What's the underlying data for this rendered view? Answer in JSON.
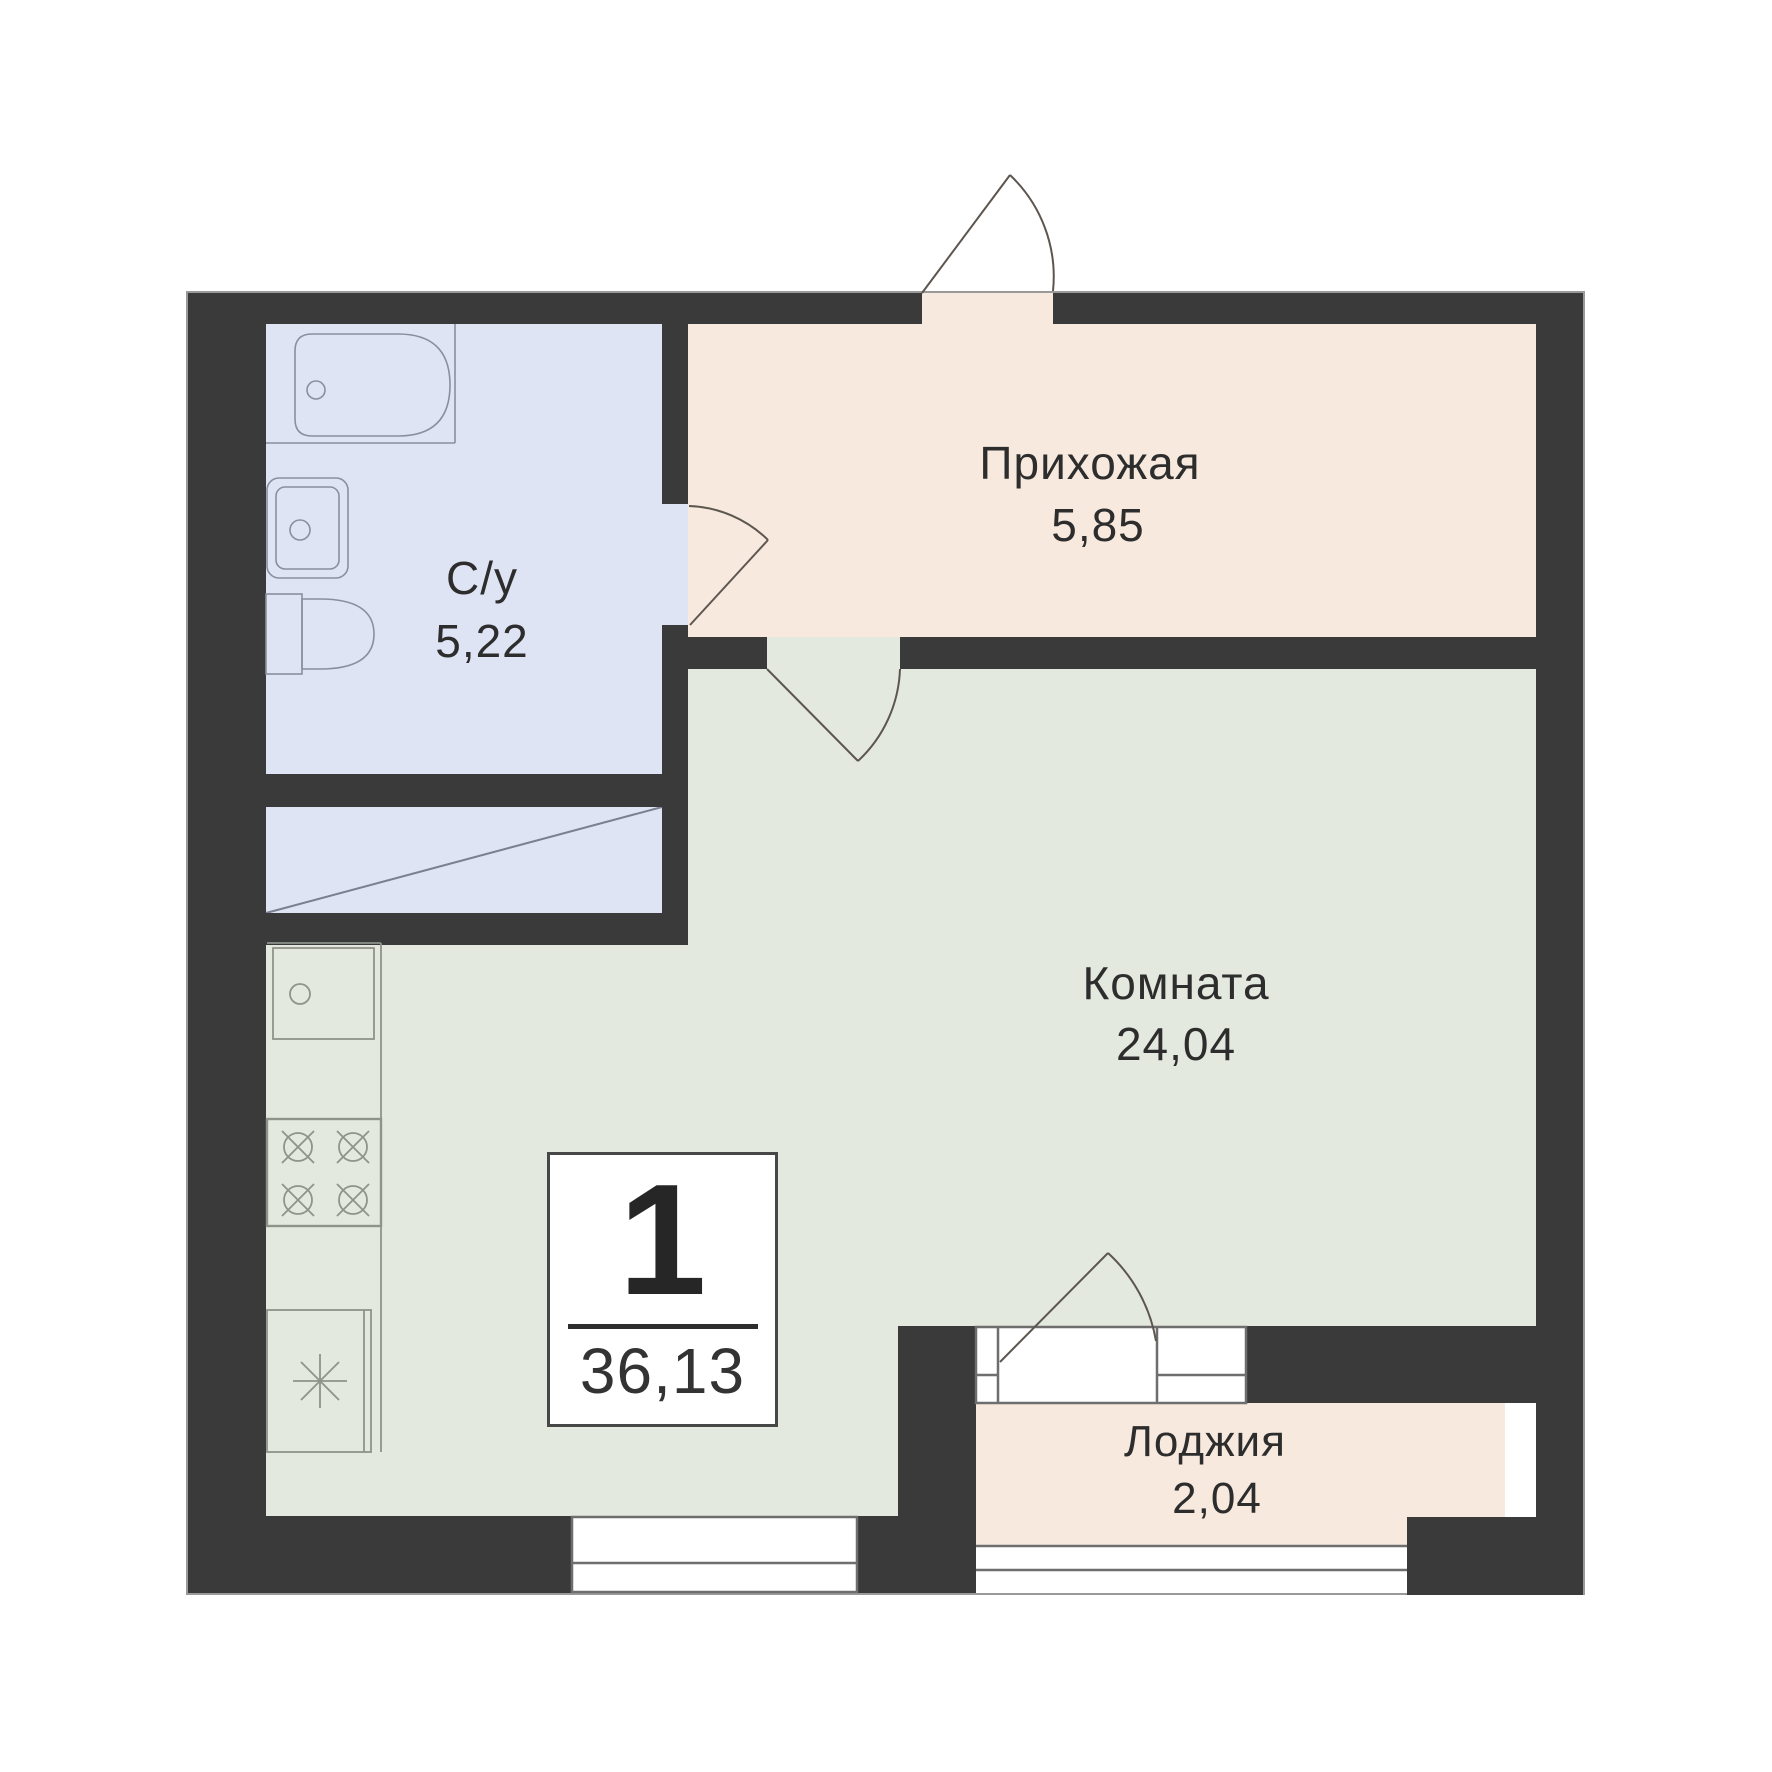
{
  "unit_card": {
    "rooms_count": "1",
    "total_area": "36,13"
  },
  "rooms": [
    {
      "name": "Прихожая",
      "area": "5,85"
    },
    {
      "name": "С/у",
      "area": "5,22"
    },
    {
      "name": "Комната",
      "area": "24,04"
    },
    {
      "name": "Лоджия",
      "area": "2,04"
    }
  ],
  "colors": {
    "wall": "#3a3a3a",
    "hallway_floor": "#f7e9de",
    "bathroom_floor": "#dfe4f5",
    "room_floor": "#e3e9df",
    "loggia_floor": "#f7e9de",
    "window_frame": "#6e6e6e",
    "door_line": "#5d564f",
    "bath_fixture_line": "#8a8fa0",
    "kitchen_fixture_line": "#8d948a",
    "text": "#2d2d2d"
  }
}
